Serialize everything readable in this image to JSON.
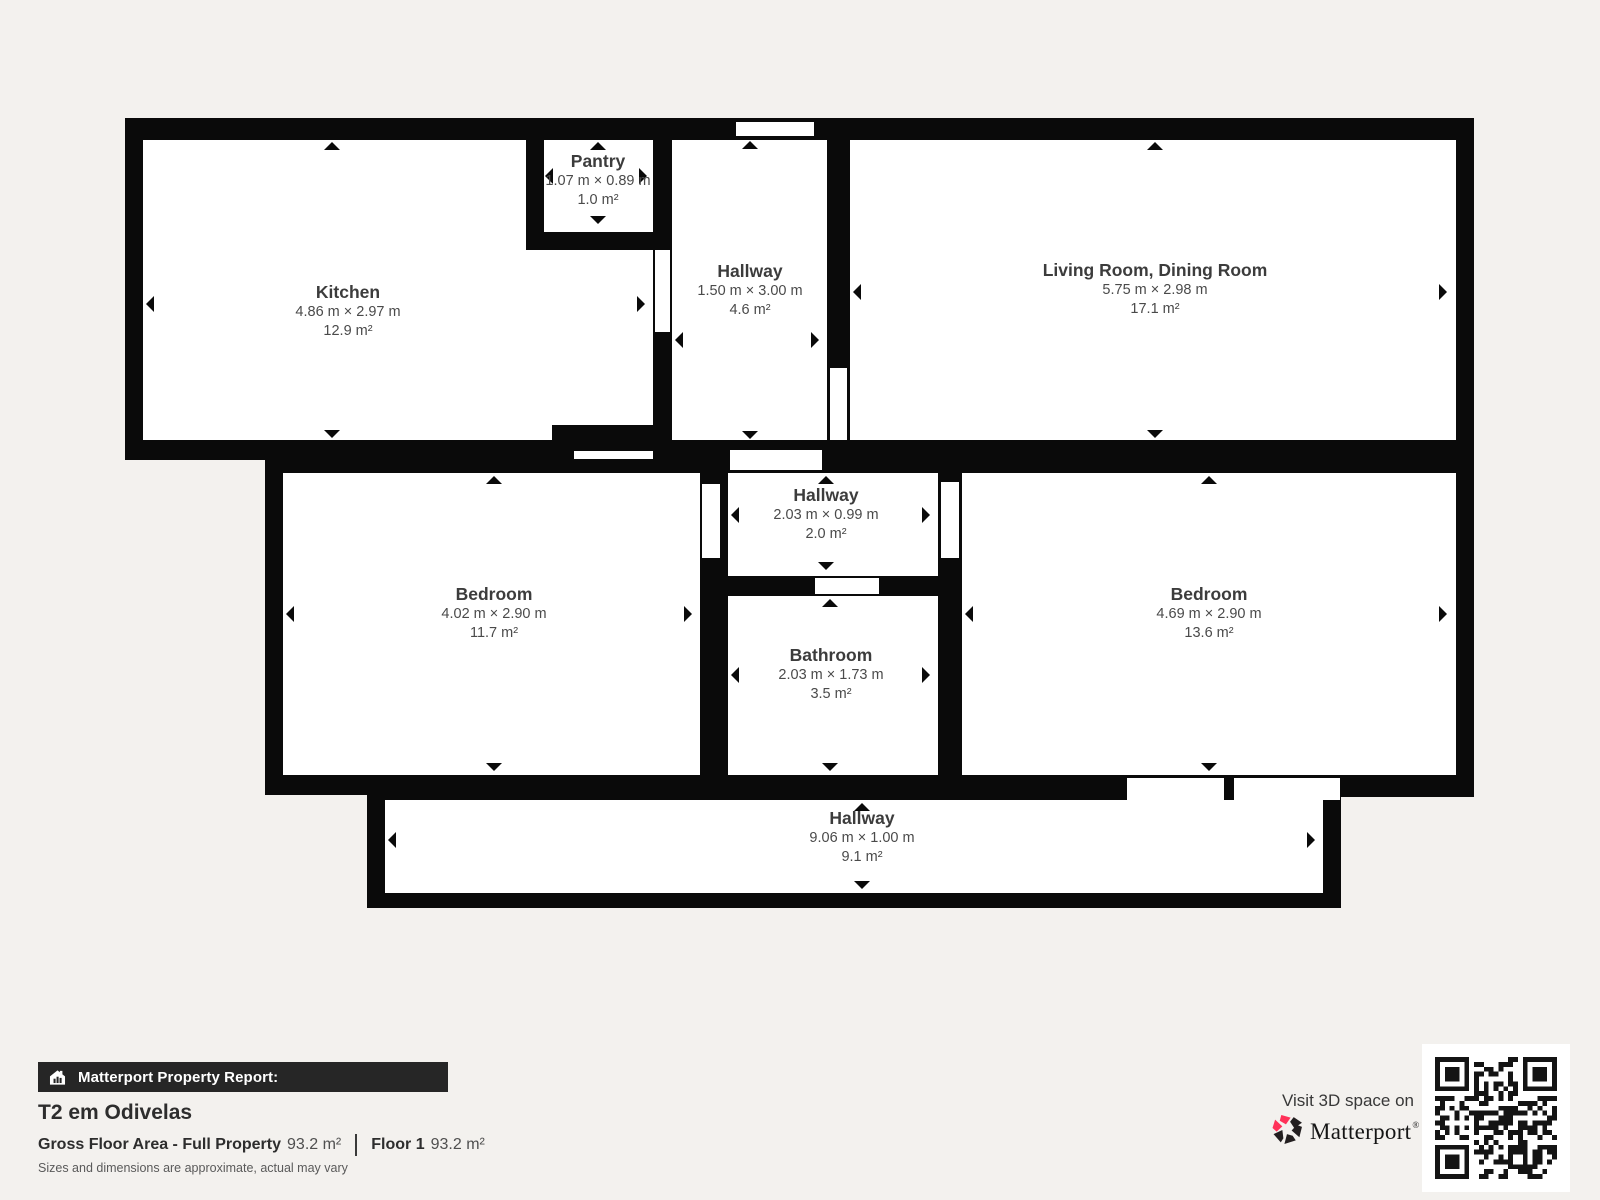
{
  "page": {
    "bg": "#f3f1ee"
  },
  "plan": {
    "wall_color": "#0a0a0a",
    "rooms": [
      {
        "name": "Kitchen",
        "dims": "4.86 m × 2.97 m",
        "area": "12.9 m²"
      },
      {
        "name": "Pantry",
        "dims": "1.07 m × 0.89 m",
        "area": "1.0 m²"
      },
      {
        "name": "Hallway",
        "dims": "1.50 m × 3.00 m",
        "area": "4.6 m²"
      },
      {
        "name": "Living Room, Dining Room",
        "dims": "5.75 m × 2.98 m",
        "area": "17.1 m²"
      },
      {
        "name": "Hallway",
        "dims": "2.03 m × 0.99 m",
        "area": "2.0 m²"
      },
      {
        "name": "Bedroom",
        "dims": "4.02 m × 2.90 m",
        "area": "11.7 m²"
      },
      {
        "name": "Bathroom",
        "dims": "2.03 m × 1.73 m",
        "area": "3.5 m²"
      },
      {
        "name": "Bedroom",
        "dims": "4.69 m × 2.90 m",
        "area": "13.6 m²"
      },
      {
        "name": "Hallway",
        "dims": "9.06 m × 1.00 m",
        "area": "9.1 m²"
      }
    ]
  },
  "report": {
    "bar_label": "Matterport Property Report:",
    "title": "T2 em Odivelas",
    "gfa_label": "Gross Floor Area - Full Property",
    "gfa_value": "93.2 m²",
    "floor_label": "Floor 1",
    "floor_value": "93.2 m²",
    "disclaimer": "Sizes and dimensions are approximate, actual may vary"
  },
  "branding": {
    "visit_label": "Visit 3D space on",
    "brand_name": "Matterport",
    "reg_mark": "®",
    "accent_color": "#ff3158"
  },
  "icons": {
    "report_bar": "house-chart-icon",
    "brand": "matterport-pinwheel-icon",
    "qr": "qr-code"
  }
}
